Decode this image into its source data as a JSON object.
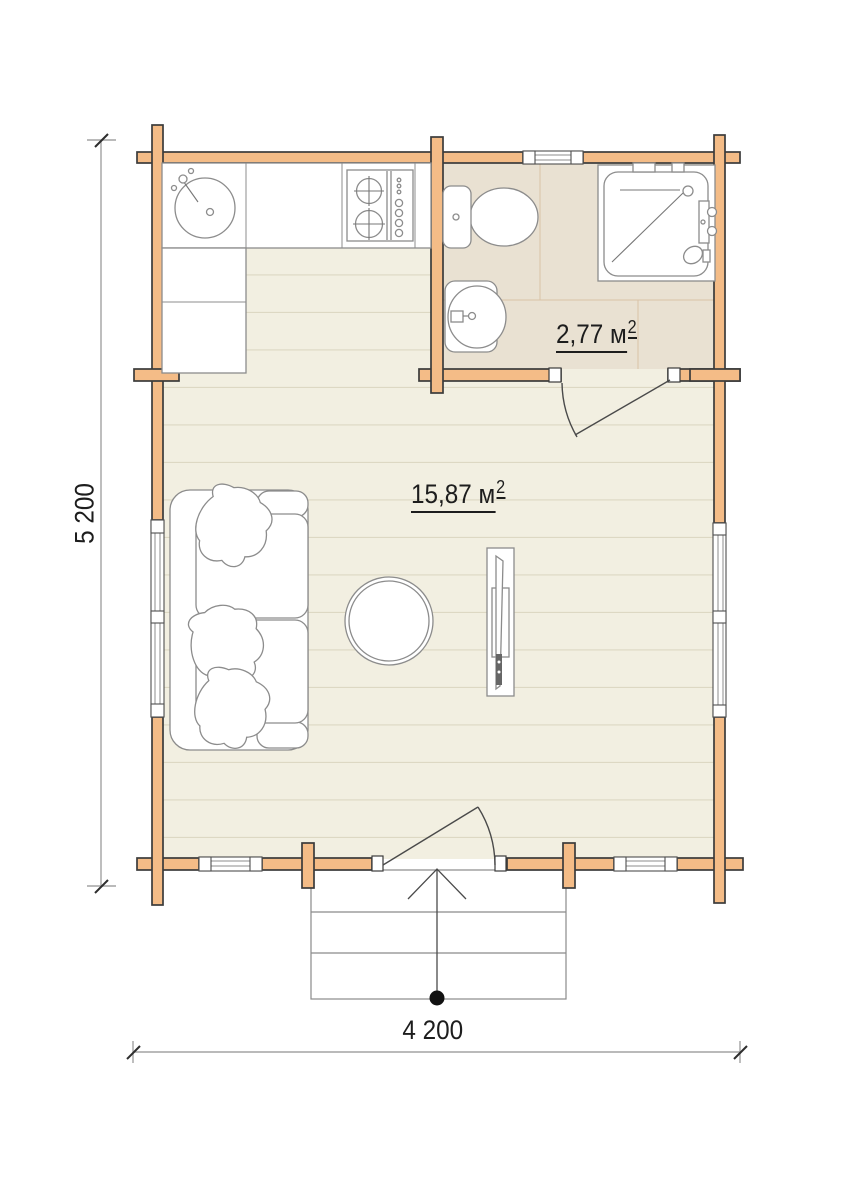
{
  "floorplan": {
    "rooms": [
      {
        "id": "living-kitchen-room",
        "area_value": "15,87 м",
        "area_superscript": "2"
      },
      {
        "id": "bathroom",
        "area_value": "2,77 м",
        "area_superscript": "2"
      }
    ],
    "dimensions": {
      "width_label": "4 200",
      "height_label": "5 200"
    },
    "colors": {
      "log_wall_fill": "#f4bc87",
      "wall_outline": "#3b3b3b",
      "wood_floor": "#f2efe1",
      "floor_plank_line": "#ddd8c3",
      "bathroom_tile": "#e9e1d2",
      "tile_grid_line": "#d9c3a7",
      "fixture_outline": "#8c8c8c",
      "dimension_line": "#a3a3a3",
      "label_text": "#1d1d1d"
    },
    "fixtures": [
      "kitchen-sink",
      "kitchen-counter",
      "stove",
      "toilet",
      "washbasin",
      "shower-cabin",
      "sofa",
      "coffee-table",
      "tv-stand",
      "entrance-steps",
      "entry-direction-arrow"
    ]
  }
}
